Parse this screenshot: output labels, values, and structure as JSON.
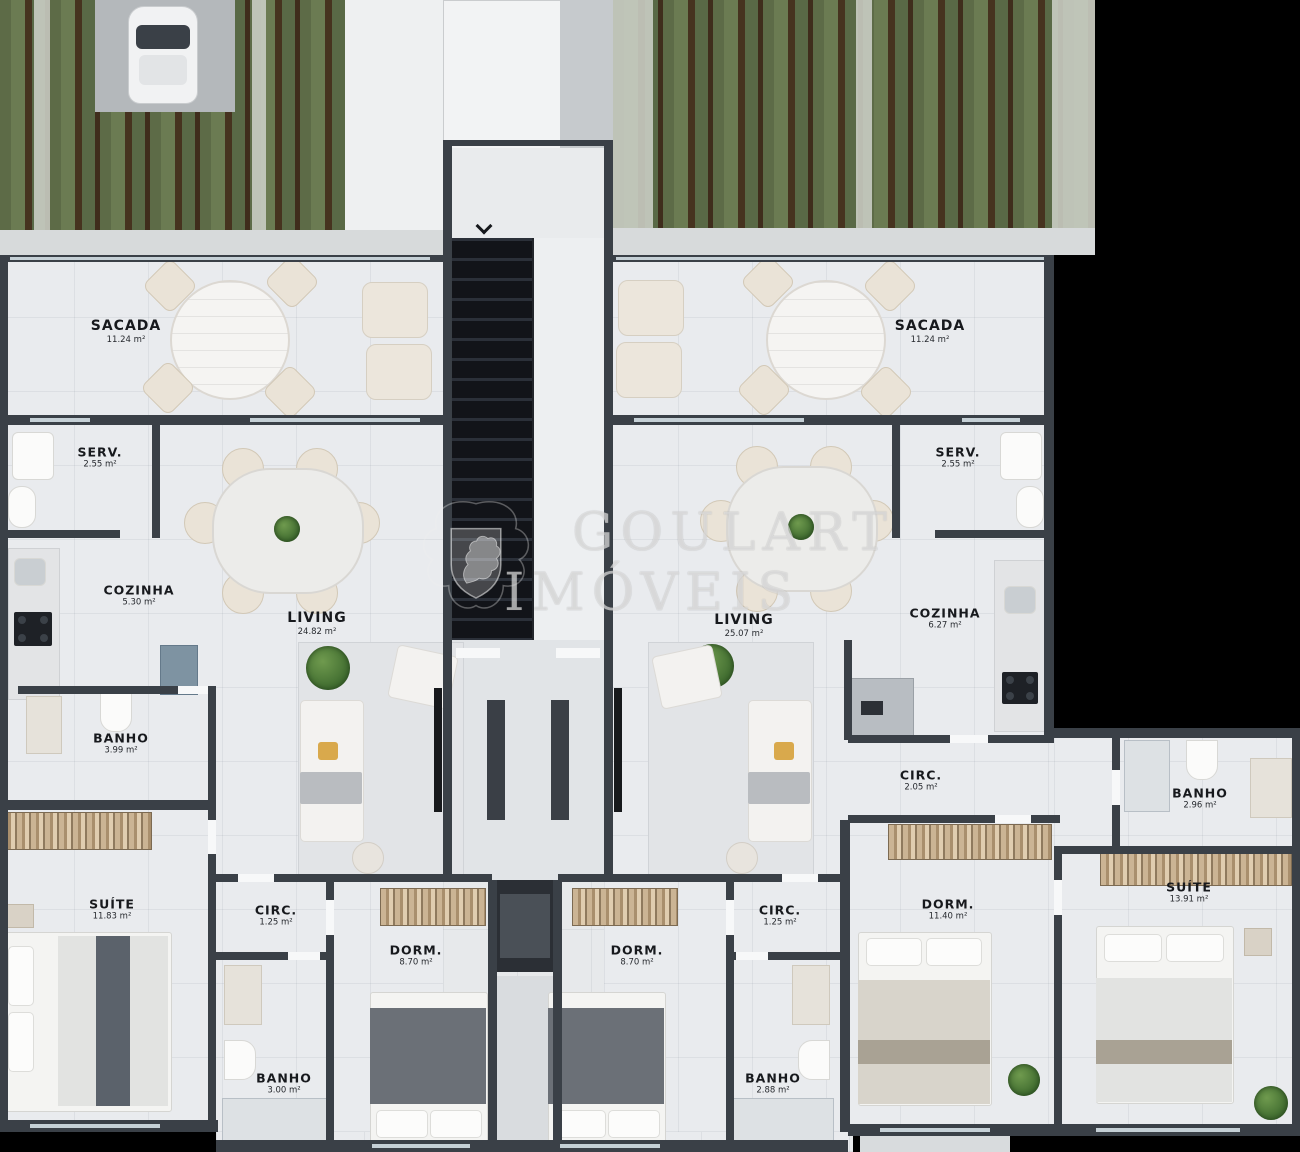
{
  "watermark": {
    "line1": "GOULART",
    "line2": "IMÓVEIS",
    "crest_icon": "heraldic-lion-crest"
  },
  "stairs": {
    "arrow_icon": "chevron-down"
  },
  "colors": {
    "background": "#000000",
    "wall": "#3a4047",
    "floor": "#e9ebee",
    "garden_green": "#66754e",
    "pergola_beam": "#46331f",
    "stair_dark": "#121419",
    "wardrobe_wood": "#c3a988",
    "accent_cushion": "#d9a94c",
    "watermark_text": "rgba(248,248,248,0.58)"
  },
  "rooms": [
    {
      "id": "sacada-left",
      "name": "SACADA",
      "area": "11.24 m²"
    },
    {
      "id": "serv-left",
      "name": "SERV.",
      "area": "2.55 m²"
    },
    {
      "id": "cozinha-left",
      "name": "COZINHA",
      "area": "5.30 m²"
    },
    {
      "id": "living-left",
      "name": "LIVING",
      "area": "24.82 m²"
    },
    {
      "id": "banho-left",
      "name": "BANHO",
      "area": "3.99 m²"
    },
    {
      "id": "suite-left",
      "name": "SUÍTE",
      "area": "11.83 m²"
    },
    {
      "id": "circ-left",
      "name": "CIRC.",
      "area": "1.25 m²"
    },
    {
      "id": "dorm-left",
      "name": "DORM.",
      "area": "8.70 m²"
    },
    {
      "id": "banho-left-2",
      "name": "BANHO",
      "area": "3.00 m²"
    },
    {
      "id": "sacada-right",
      "name": "SACADA",
      "area": "11.24 m²"
    },
    {
      "id": "serv-right",
      "name": "SERV.",
      "area": "2.55 m²"
    },
    {
      "id": "living-right",
      "name": "LIVING",
      "area": "25.07 m²"
    },
    {
      "id": "cozinha-right",
      "name": "COZINHA",
      "area": "6.27 m²"
    },
    {
      "id": "circ-right",
      "name": "CIRC.",
      "area": "2.05 m²"
    },
    {
      "id": "banho-right-wing",
      "name": "BANHO",
      "area": "2.96 m²"
    },
    {
      "id": "circ-right-2",
      "name": "CIRC.",
      "area": "1.25 m²"
    },
    {
      "id": "dorm-right",
      "name": "DORM.",
      "area": "8.70 m²"
    },
    {
      "id": "dorm-right-2",
      "name": "DORM.",
      "area": "11.40 m²"
    },
    {
      "id": "suite-right",
      "name": "SUÍTE",
      "area": "13.91 m²"
    },
    {
      "id": "banho-right-2",
      "name": "BANHO",
      "area": "2.88 m²"
    }
  ]
}
